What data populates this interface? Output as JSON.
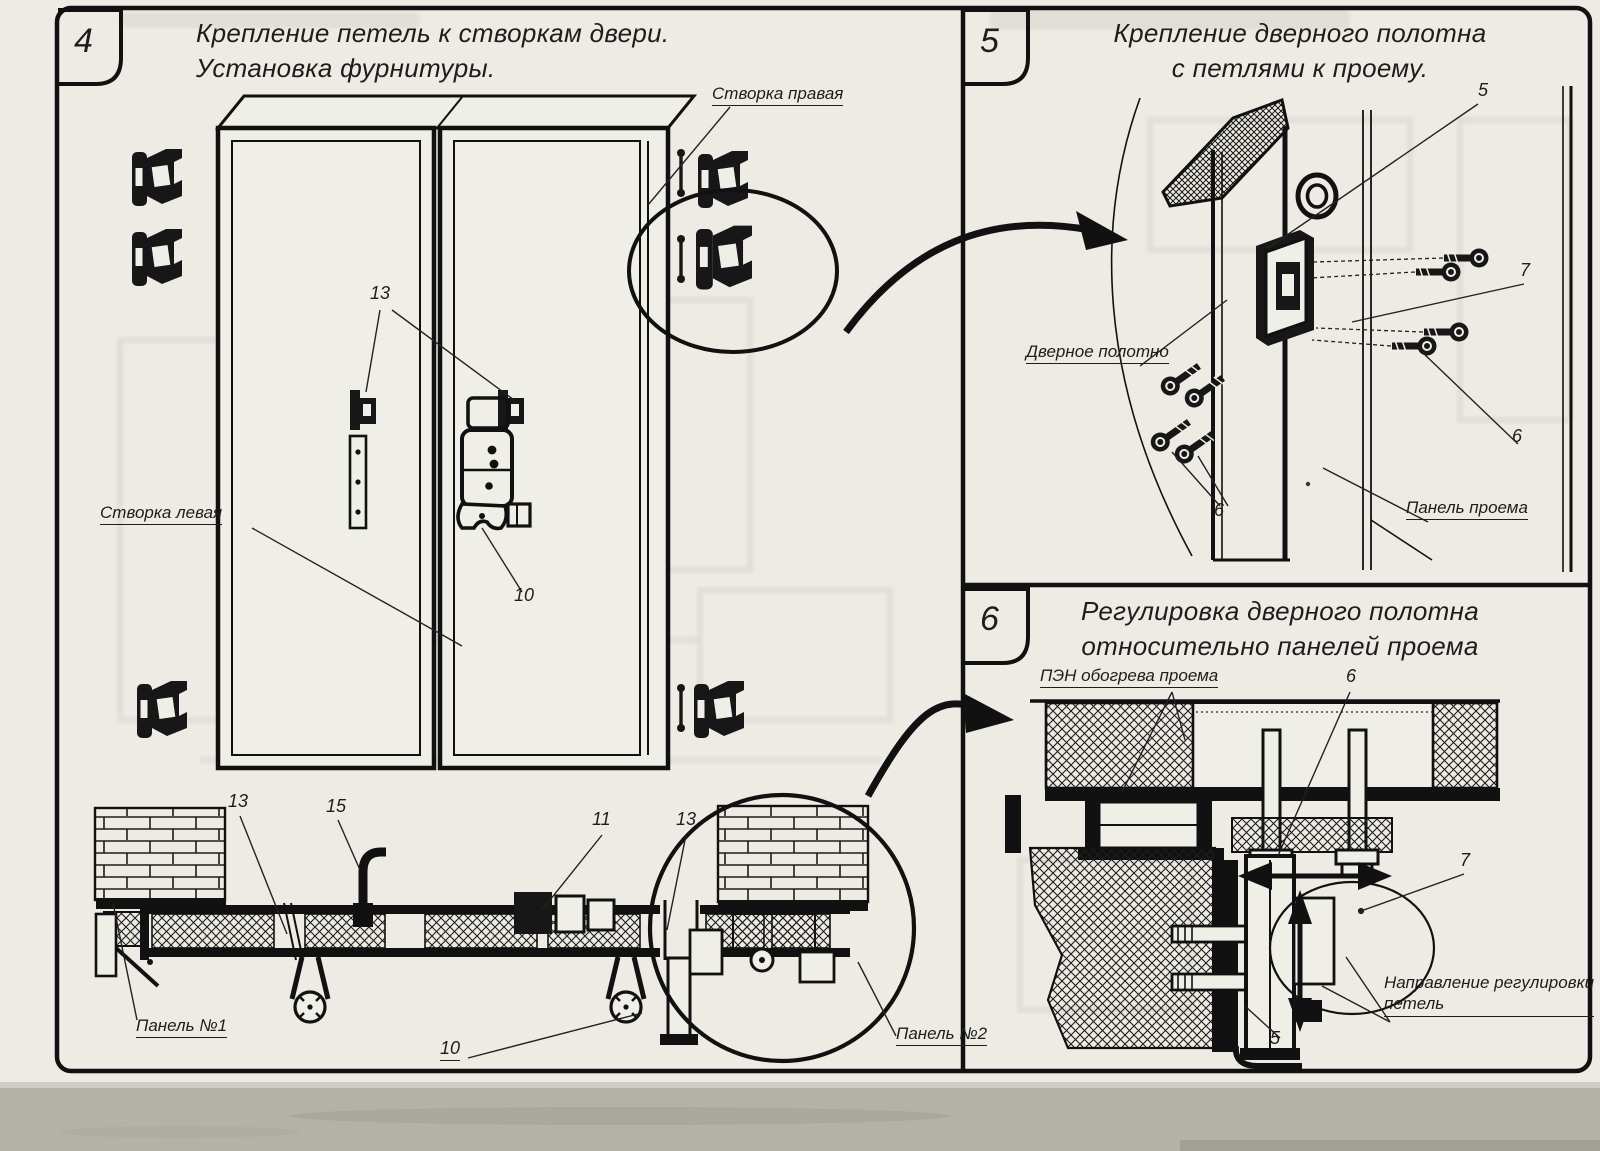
{
  "panel4": {
    "number": "4",
    "title1": "Крепление петель к створкам двери.",
    "title2": "Установка фурнитуры.",
    "labels": {
      "right_leaf": "Створка правая",
      "left_leaf": "Створка левая",
      "hinge_top": "13",
      "latch_mid": "10",
      "sec_13_left": "13",
      "sec_15": "15",
      "sec_11": "11",
      "sec_13_right": "13",
      "sec_10": "10",
      "panel_no1": "Панель №1",
      "panel_no2": "Панель №2"
    }
  },
  "panel5": {
    "number": "5",
    "title1": "Крепление дверного полотна",
    "title2": "с петлями к проему.",
    "labels": {
      "n5": "5",
      "n7": "7",
      "n6_right": "6",
      "n6_left": "6",
      "door_leaf": "Дверное полотно",
      "opening_panel": "Панель проема"
    }
  },
  "panel6": {
    "number": "6",
    "title1": "Регулировка дверного полотна",
    "title2": "относительно панелей проема",
    "labels": {
      "pen_heater": "ПЭН обогрева проема",
      "n6": "6",
      "n7": "7",
      "n5": "5",
      "direction1": "Направление регулировки",
      "direction2": "петель"
    }
  }
}
